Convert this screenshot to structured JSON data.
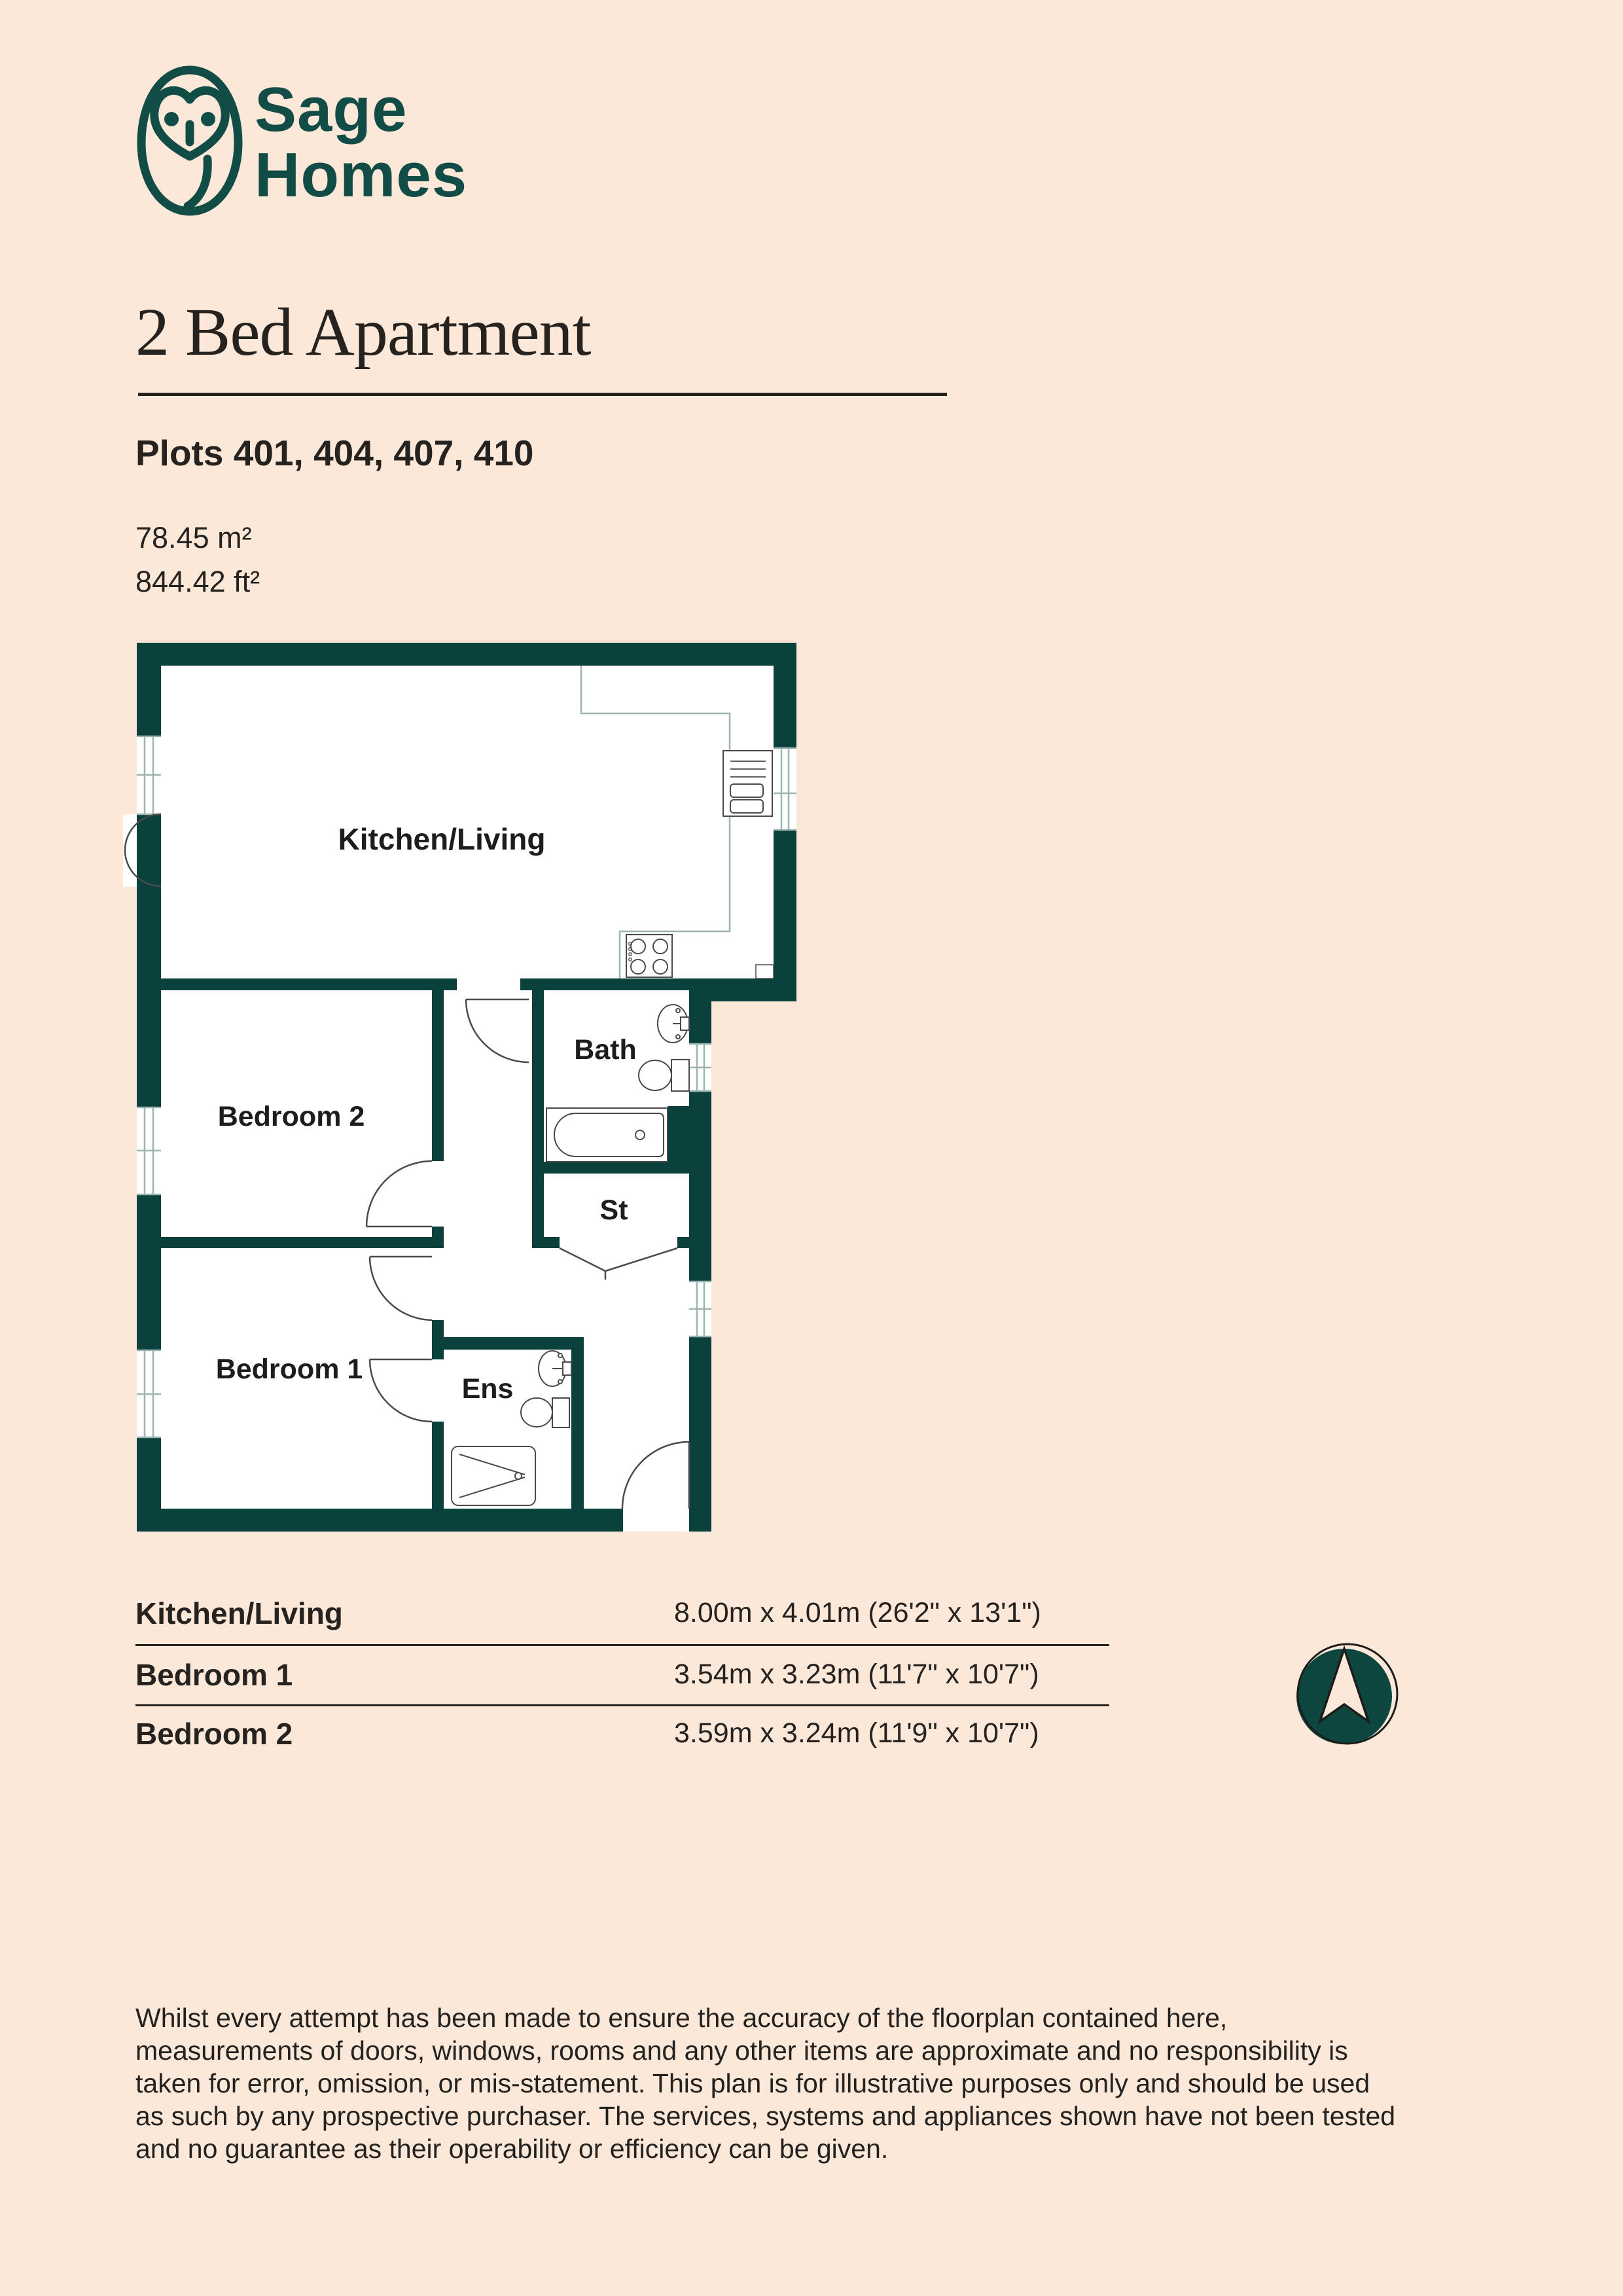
{
  "page": {
    "background": "#fce8d8",
    "wall_color": "#0a413d",
    "brand_color": "#114c46",
    "ink_color": "#262220"
  },
  "logo": {
    "line1": "Sage",
    "line2": "Homes"
  },
  "header": {
    "title": "2 Bed Apartment",
    "plots": "Plots 401, 404, 407, 410",
    "area_m2": "78.45 m²",
    "area_ft2": "844.42 ft²"
  },
  "floorplan": {
    "rooms": [
      {
        "label": "Kitchen/Living"
      },
      {
        "label": "Bedroom 2"
      },
      {
        "label": "Bath"
      },
      {
        "label": "St"
      },
      {
        "label": "Bedroom 1"
      },
      {
        "label": "Ens"
      }
    ]
  },
  "dimensions": {
    "rows": [
      {
        "name": "Kitchen/Living",
        "size": "8.00m x 4.01m (26'2\" x 13'1\")"
      },
      {
        "name": "Bedroom 1",
        "size": "3.54m x 3.23m (11'7\" x 10'7\")"
      },
      {
        "name": "Bedroom 2",
        "size": "3.59m x 3.24m (11'9\" x 10'7\")"
      }
    ]
  },
  "compass": {
    "direction": "north"
  },
  "disclaimer": {
    "lines": [
      "Whilst every attempt has been made to ensure the accuracy of the floorplan contained here,",
      "measurements of doors, windows, rooms and any other items are approximate and no responsibility is",
      "taken for error, omission, or mis-statement. This plan is for illustrative purposes only and should be used",
      "as such by any prospective purchaser. The services, systems and appliances shown have not been tested",
      "and no guarantee as their operability or efficiency can be given."
    ]
  }
}
